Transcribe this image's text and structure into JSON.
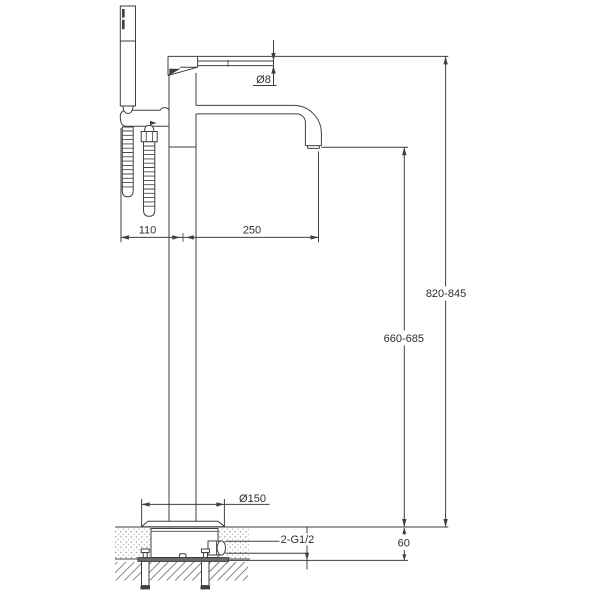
{
  "drawing": {
    "kind": "freestanding bathtub faucet installation diagram",
    "background_color": "#ffffff",
    "line_color": "#3f3f3f",
    "text_color": "#2e2e2e"
  },
  "dimensions": {
    "handle_diameter": {
      "label": "Ø8"
    },
    "shower_offset": {
      "label": "110"
    },
    "spout_reach": {
      "label": "250"
    },
    "overall_height": {
      "label": "820-845"
    },
    "spout_height": {
      "label": "660-685"
    },
    "base_diameter": {
      "label": "Ø150"
    },
    "inlet_connections": {
      "label": "2-G1/2"
    },
    "floor_embed_depth": {
      "label": "60"
    }
  }
}
